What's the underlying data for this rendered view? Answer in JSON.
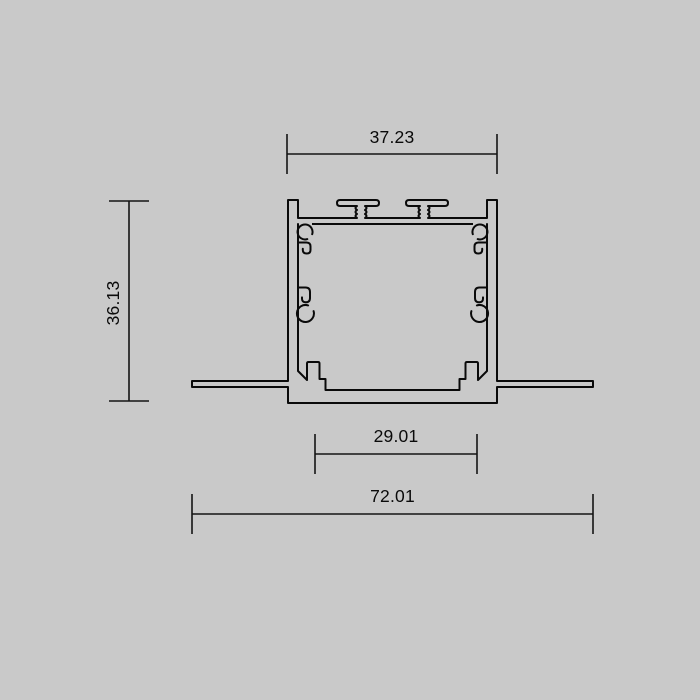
{
  "canvas": {
    "background_color": "#c9c9c9",
    "line_color": "#0a0a0a",
    "width_px": 700,
    "height_px": 700
  },
  "drawing": {
    "type": "technical-cross-section",
    "subject": "recessed-mount aluminium profile cross-section with side flanges, top mounting hooks and internal clip grooves",
    "dimensions": [
      {
        "id": "top-outer-width",
        "value": "37.23",
        "orientation": "horizontal",
        "position": "above profile body"
      },
      {
        "id": "overall-height",
        "value": "36.13",
        "orientation": "vertical",
        "position": "left of profile, text rotated 90deg"
      },
      {
        "id": "inner-channel-width",
        "value": "29.01",
        "orientation": "horizontal",
        "position": "below profile, first row"
      },
      {
        "id": "overall-width",
        "value": "72.01",
        "orientation": "horizontal",
        "position": "below profile, second row, flange tip to flange tip"
      }
    ]
  }
}
